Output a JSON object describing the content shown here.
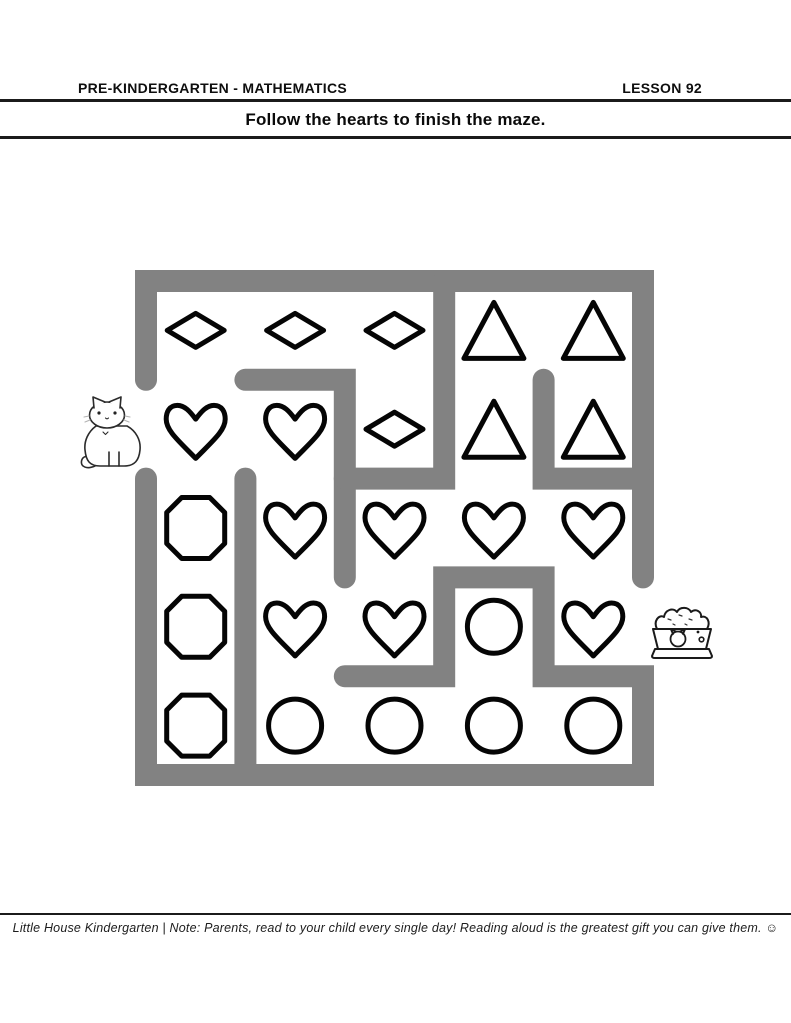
{
  "header": {
    "course_label": "PRE-KINDERGARTEN - MATHEMATICS",
    "lesson_label": "LESSON 92"
  },
  "instruction": {
    "text": "Follow the hearts to finish the maze."
  },
  "footer": {
    "text": "Little House Kindergarten | Note: Parents, read to your child every single day! Reading aloud is the greatest gift you can give them. ☺"
  },
  "maze": {
    "wall_color": "#828282",
    "wall_thickness": 22,
    "shape_stroke_color": "#050505",
    "shape_stroke_width": 5,
    "grid": {
      "cols": 5,
      "rows": 5,
      "x0": 146,
      "y0": 281,
      "cell_w": 99.4,
      "cell_h": 98.8
    },
    "cells": [
      [
        "diamond",
        "diamond",
        "diamond",
        "triangle",
        "triangle"
      ],
      [
        "heart",
        "heart",
        "diamond",
        "triangle",
        "triangle"
      ],
      [
        "octagon",
        "heart",
        "heart",
        "heart",
        "heart"
      ],
      [
        "octagon",
        "heart",
        "heart",
        "circle",
        "heart"
      ],
      [
        "octagon",
        "circle",
        "circle",
        "circle",
        "circle"
      ]
    ],
    "shape_sizes": {
      "diamond": {
        "w": 57,
        "h": 34
      },
      "triangle": {
        "w": 60,
        "h": 56
      },
      "heart": {
        "w": 59,
        "h": 53
      },
      "octagon": {
        "w": 58,
        "h": 61
      },
      "circle": {
        "r": 26.5
      }
    },
    "walls": {
      "paths": [
        [
          [
            0,
            1
          ],
          [
            0,
            0
          ],
          [
            5,
            0
          ],
          [
            5,
            3
          ]
        ],
        [
          [
            0,
            2
          ],
          [
            0,
            5
          ],
          [
            5,
            5
          ],
          [
            5,
            4
          ],
          [
            4,
            4
          ],
          [
            4,
            3
          ],
          [
            3,
            3
          ],
          [
            3,
            4
          ],
          [
            2,
            4
          ]
        ],
        [
          [
            1,
            1
          ],
          [
            2,
            1
          ],
          [
            2,
            3
          ]
        ],
        [
          [
            3,
            0
          ],
          [
            3,
            2
          ],
          [
            2,
            2
          ]
        ],
        [
          [
            4,
            1
          ],
          [
            4,
            2
          ],
          [
            5,
            2
          ]
        ],
        [
          [
            1,
            2
          ],
          [
            1,
            5
          ]
        ]
      ]
    },
    "start": {
      "icon": "cat-icon",
      "side": "left",
      "row": 2
    },
    "end": {
      "icon": "food-bowl-icon",
      "side": "right",
      "row": 4
    }
  }
}
